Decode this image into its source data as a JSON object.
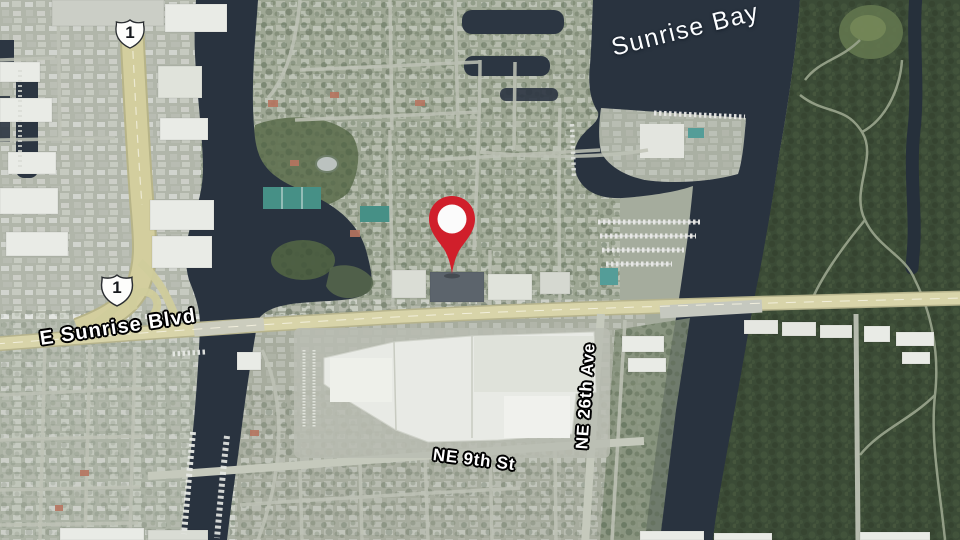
{
  "map": {
    "style": "satellite",
    "labels": {
      "water_body": "Sunrise Bay",
      "boulevard": "E Sunrise Blvd",
      "street": "NE 9th St",
      "avenue": "NE 26th Ave"
    },
    "route_shields": [
      {
        "number": "1"
      },
      {
        "number": "1"
      }
    ],
    "marker": {
      "color": "#d01f2b"
    },
    "palette": {
      "water": "#212b38",
      "vegetation": "#36462f",
      "road_major": "#d6d2a4",
      "urban": "#b6bab0"
    }
  }
}
